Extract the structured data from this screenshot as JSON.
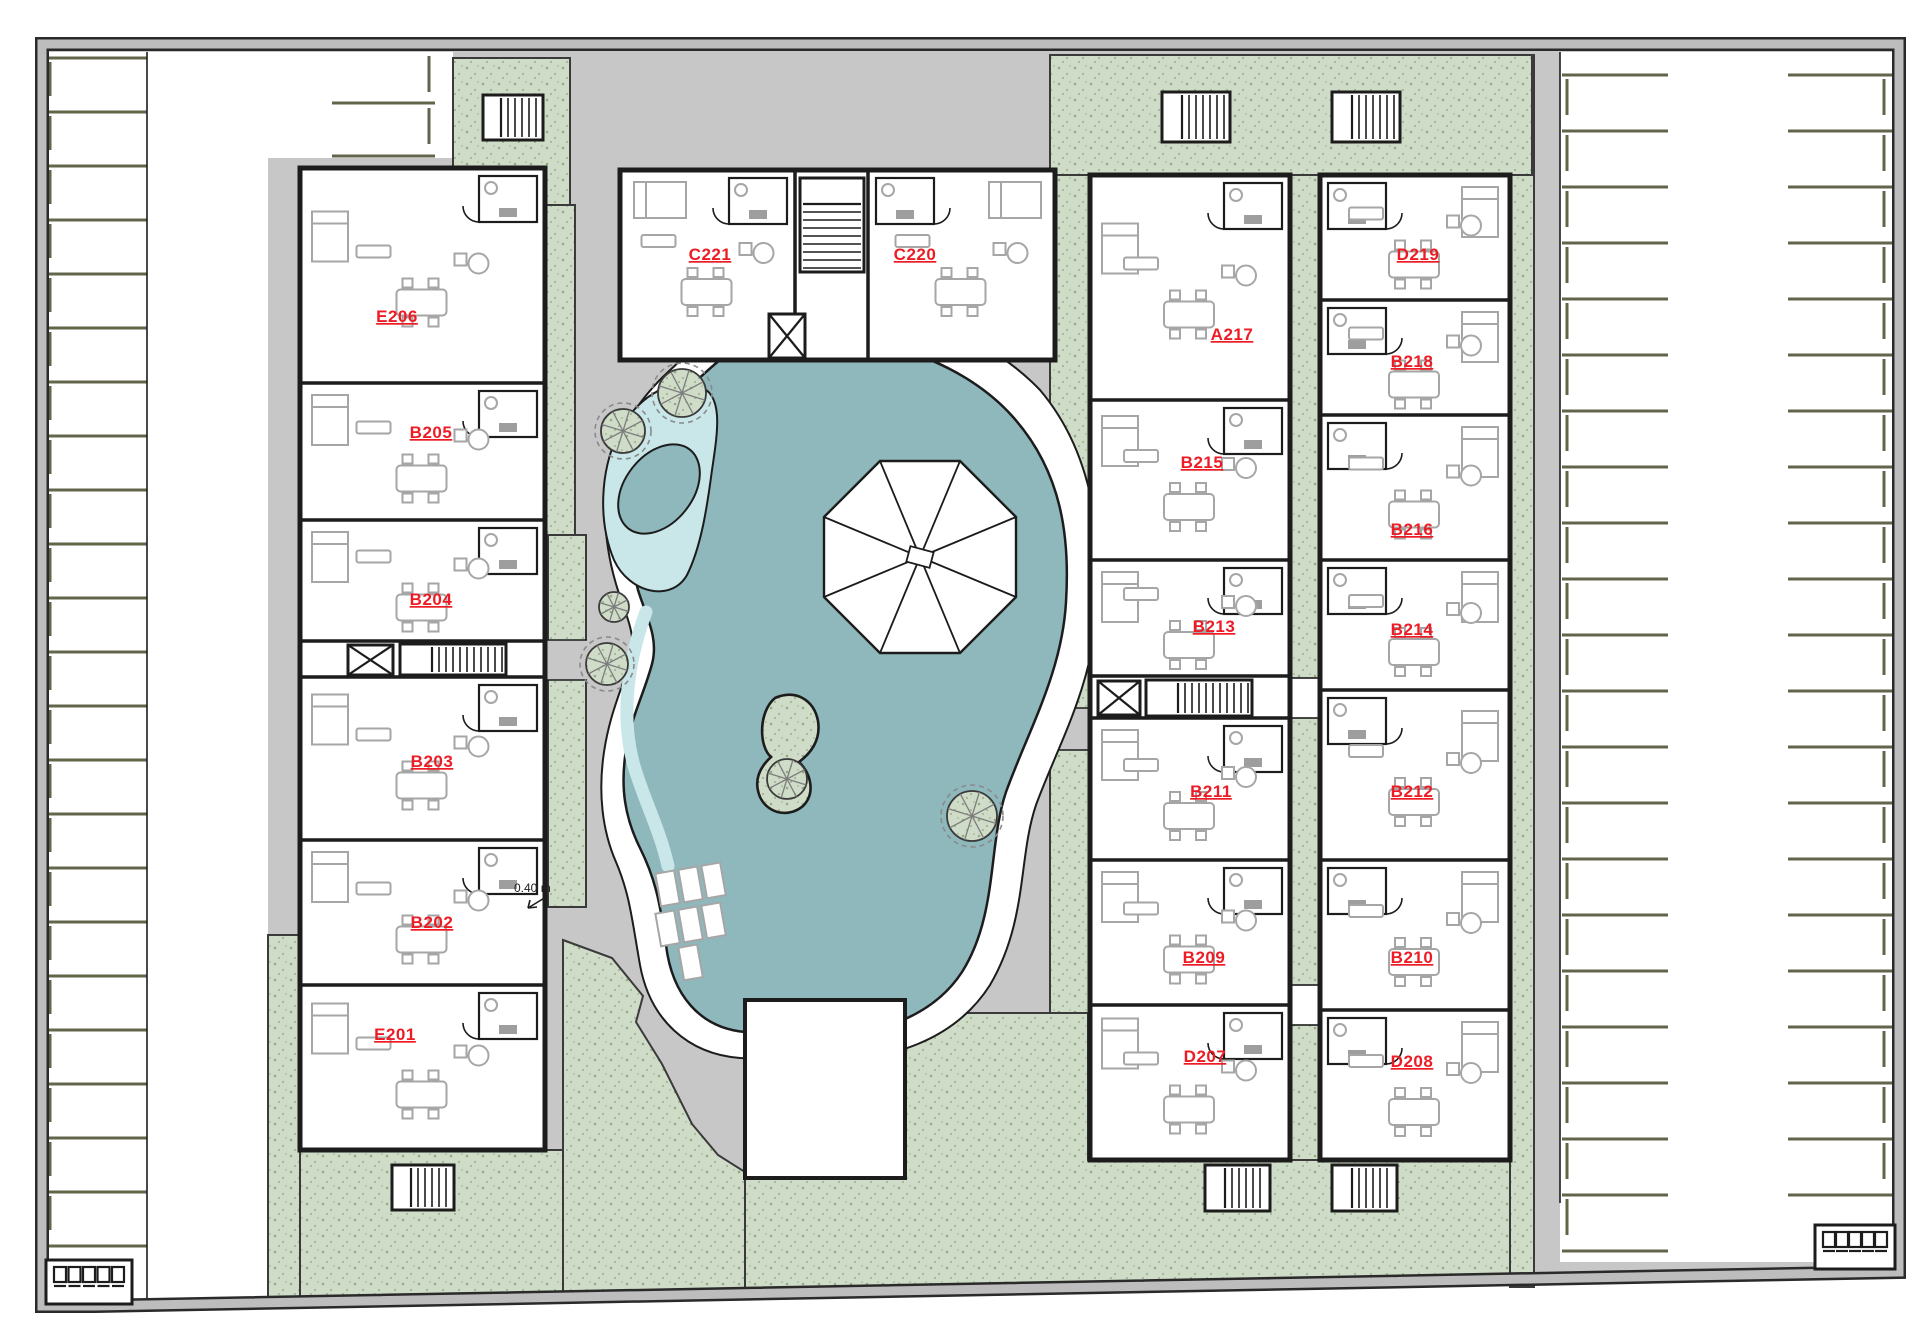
{
  "plan": {
    "buildings": {
      "west": {
        "units": [
          {
            "label": "E206"
          },
          {
            "label": "B205"
          },
          {
            "label": "B204"
          },
          {
            "label": "B203"
          },
          {
            "label": "B202"
          },
          {
            "label": "E201"
          }
        ]
      },
      "north": {
        "units": [
          {
            "label": "C221"
          },
          {
            "label": "C220"
          }
        ]
      },
      "east_inner": {
        "units": [
          {
            "label": "A217"
          },
          {
            "label": "B215"
          },
          {
            "label": "B213"
          },
          {
            "label": "B211"
          },
          {
            "label": "B209"
          },
          {
            "label": "D207"
          }
        ]
      },
      "east_outer": {
        "units": [
          {
            "label": "D219"
          },
          {
            "label": "B218"
          },
          {
            "label": "B216"
          },
          {
            "label": "B214"
          },
          {
            "label": "B212"
          },
          {
            "label": "B210"
          },
          {
            "label": "D208"
          }
        ]
      }
    },
    "annotations": {
      "depth_label": "0.40 m"
    },
    "colors": {
      "unit_label": "#ed1c24",
      "pool_water": "#8fb8bd",
      "pool_shallow": "#c9e6e9",
      "landscape_green": "#cfdcc8",
      "hardscape_gray": "#c7c7c7",
      "boundary_wall_gray": "#bdbdbd",
      "parking_line_olive": "#63654a",
      "wall_black": "#1c1c1c"
    }
  }
}
